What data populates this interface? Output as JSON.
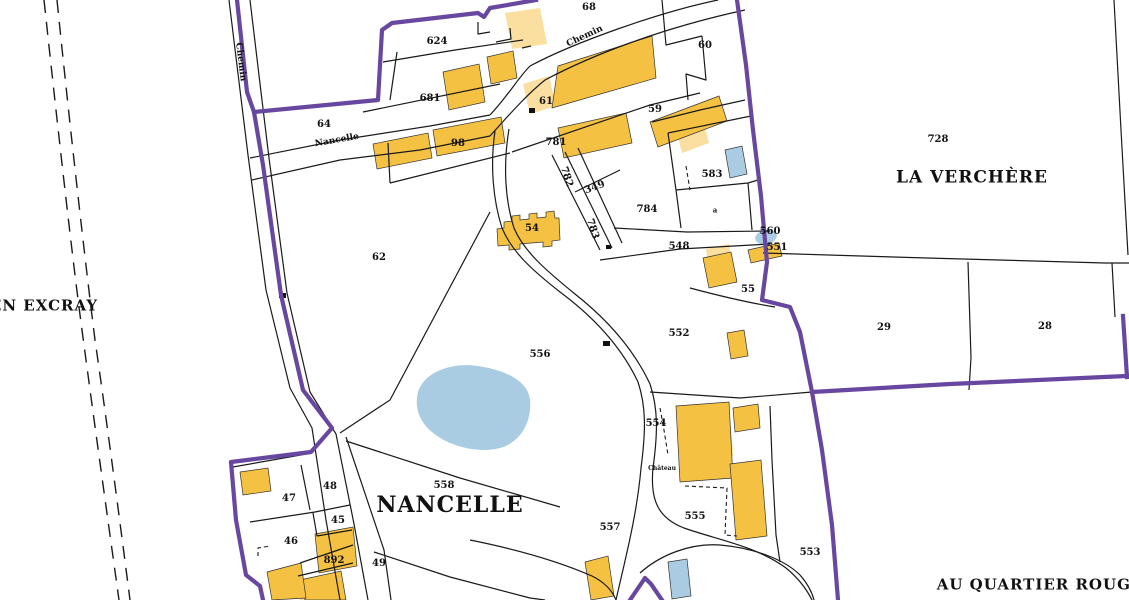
{
  "map": {
    "title": "Cadastral map extract",
    "colors": {
      "boundary_purple": "#6847A0",
      "building_orange": "#F5C142",
      "building_pale": "#FADFA0",
      "water_blue": "#A9CCE3",
      "line_black": "#1A1A1A",
      "background": "#FFFFFF"
    },
    "labels": {
      "p68": "68",
      "p624": "624",
      "p60": "60",
      "p681": "681",
      "p64": "64",
      "p61": "61",
      "p59": "59",
      "p781": "781",
      "p98": "98",
      "p583": "583",
      "p728": "728",
      "p782": "782",
      "p349": "349",
      "p784": "784",
      "pa": "a",
      "p783": "783",
      "p54": "54",
      "p560": "560",
      "p548": "548",
      "p551": "551",
      "p62": "62",
      "p55": "55",
      "p552": "552",
      "p29": "29",
      "p28": "28",
      "p556": "556",
      "p554": "554",
      "chateau": "Château",
      "p558": "558",
      "p48": "48",
      "p47": "47",
      "p45": "45",
      "p557": "557",
      "p555": "555",
      "p46": "46",
      "p553": "553",
      "p892": "892",
      "p49": "49",
      "en_excray": "EN EXCRAY",
      "la_verchere": "LA VERCHÈRE",
      "nancelle_place": "NANCELLE",
      "au_quartier_rouge": "AU QUARTIER ROUGE",
      "road_chemin_w": "Chemin",
      "road_nancelle": "Nancelle",
      "road_chemin_n": "Chemin"
    }
  }
}
